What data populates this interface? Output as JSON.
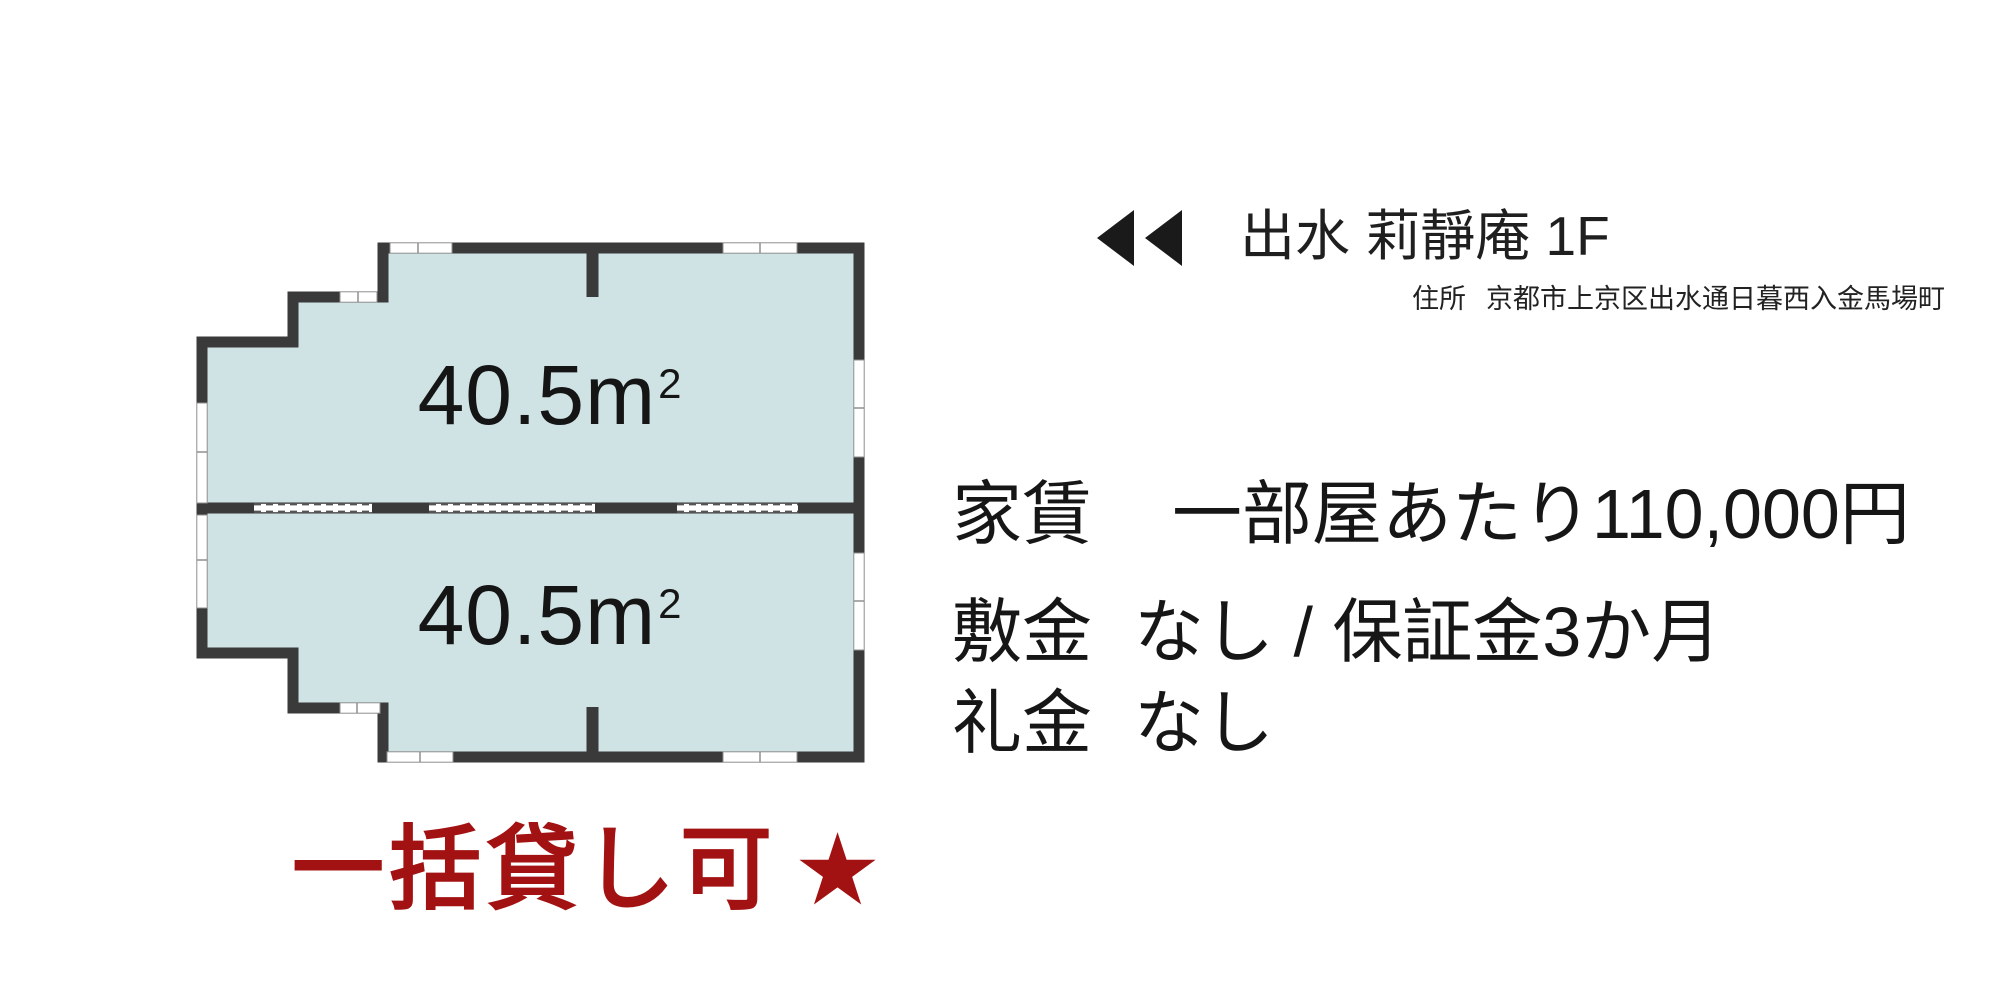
{
  "header": {
    "title": "出水 莉靜庵 1F",
    "address_label": "住所",
    "address": "京都市上京区出水通日暮西入金馬場町"
  },
  "floorplan": {
    "wall_color": "#3a3a3a",
    "room_fill_color": "#cfe2e4",
    "rooms": [
      {
        "area_value": "40.5",
        "unit_base": "m",
        "unit_exp": "2"
      },
      {
        "area_value": "40.5",
        "unit_base": "m",
        "unit_exp": "2"
      }
    ]
  },
  "details": {
    "rows": [
      {
        "label": "家賃",
        "value": "一部屋あたり110,000円"
      },
      {
        "label": "敷金",
        "value": "なし / 保証金3か月"
      },
      {
        "label": "礼金",
        "value": "なし"
      }
    ]
  },
  "banner": {
    "text": "一括貸し可",
    "star": "★",
    "color": "#a31212"
  }
}
